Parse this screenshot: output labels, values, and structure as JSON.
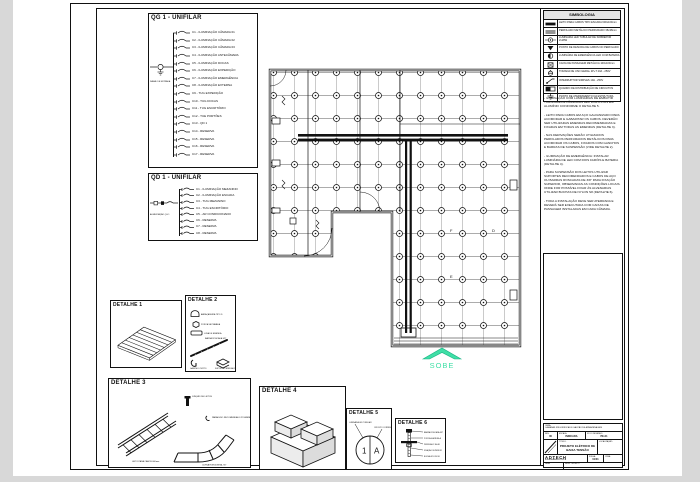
{
  "colors": {
    "background": "#d8d8d8",
    "paper": "#ffffff",
    "ink": "#111111",
    "accent_teal": "#3fdfa6",
    "accent_teal_dark": "#17b183"
  },
  "qg_panel": {
    "title": "QG 1 - UNIFILAR",
    "feeder_label": "RAMAL DE ENTRADA",
    "circuits": [
      "C1 - ILUMINAÇÃO CÂMARA 01",
      "C2 - ILUMINAÇÃO CÂMARA 02",
      "C3 - ILUMINAÇÃO CÂMARA 03",
      "C4 - ILUMINAÇÃO ANTECÂMARA",
      "C5 - ILUMINAÇÃO DOCAS",
      "C6 - ILUMINAÇÃO EXPEDIÇÃO",
      "C7 - ILUMINAÇÃO EMERGÊNCIA",
      "C8 - ILUMINAÇÃO EXTERNA",
      "C9 - TUG EXPEDIÇÃO",
      "C10 - TUG DOCAS",
      "C11 - TUG ESCRITÓRIO",
      "C12 - TUE PORTÕES",
      "C13 - QD 1",
      "C14 - RESERVA",
      "C15 - RESERVA",
      "C16 - RESERVA",
      "C17 - RESERVA"
    ]
  },
  "qd_panel": {
    "title": "QD 1 - UNIFILAR",
    "feeder_label": "ALIMENTAÇÃO QG 1",
    "circuits": [
      "C1 - ILUMINAÇÃO MEZANINO",
      "C2 - ILUMINAÇÃO ESCADA",
      "C3 - TUG MEZANINO",
      "C4 - TUG ESCRITÓRIO",
      "C5 - AR CONDICIONADO",
      "C6 - RESERVA",
      "C7 - RESERVA",
      "C8 - RESERVA"
    ]
  },
  "legend": {
    "title": "SIMBOLOGIA",
    "rows": [
      {
        "icon": "cable-tray-line-icon",
        "label": "LEITO PARA CABOS TIPO ESCADA 600x100mm"
      },
      {
        "icon": "perfilado-line-icon",
        "label": "PERFILADO METÁLICO PERFURADO 38x38mm"
      },
      {
        "icon": "luminaire-icon",
        "label": "LUMINÁRIA LED TUBULAR DE SOBREPOR 2x18W"
      },
      {
        "icon": "drop-point-icon",
        "label": "PONTO DE DESCIDA DE CABOS NO PERFILADO"
      },
      {
        "icon": "emergency-luminaire-icon",
        "label": "LUMINÁRIA DE EMERGÊNCIA LED COM BATERIA"
      },
      {
        "icon": "junction-box-icon",
        "label": "CAIXA DE PASSAGEM METÁLICA 100x100mm"
      },
      {
        "icon": "outlet-icon",
        "label": "TOMADA DE USO GERAL 2P+T 20A - 250V"
      },
      {
        "icon": "switch-icon",
        "label": "INTERRUPTOR SIMPLES 10A - 250V"
      },
      {
        "icon": "panel-icon",
        "label": "QUADRO DE DISTRIBUIÇÃO DE CIRCUITOS"
      },
      {
        "icon": "ground-icon",
        "label": "PONTO DE ATERRAMENTO DA ESTRUTURA"
      }
    ]
  },
  "notes": {
    "paragraphs": [
      "- ILUMINAÇÃO COM LUMINÁRIAS DE EMBUTIR TUBULARES E LÂMPADAS LED DISPOSTAS EM ALUMÍNIO CONFORME O DETALHE 5.",
      "- LEITO PARA CABOS EM AÇO GALVANIZADO PARA ACOMODAR E GABARITAR OS CABOS. DEVERÃO SER UTILIZADAS EMENDAS RECOMENDADAS E FIXADAS EM TODAS AS EMENDAS (DETALHE 3).",
      "- NAS DERIVAÇÕES SERÃO UTILIZADOS PERFILADOS PERFURADOS METÁLICOS PARA ACOMODAR OS CABOS, FIXADOS COM GANCHOS E BARRAS DE SUSPENSÃO (VIDE DETALHE 2).",
      "- ILUMINAÇÃO DE EMERGÊNCIA: INSTALAR LUMINÁRIA DE LED COM DOIS FARÓIS E BATERIA (DETALHE 4).",
      "- PARA SUSPENSÃO DOS LEITOS UTILIZAR SUPORTES RECOMENDADOS E CABOS DE AÇO OU BARRAS ROSCADAS DE 3/8\" PARA FIXAÇÃO SUPERIOR, OBSERVADAS AS CONDIÇÕES LOCAIS. ONDE FOR POSSÍVEL FIXAR ÀS ALVENARIAS UTILIZAR BUCHAS DE NYLON S8 (DETALHE 6).",
      "- TODA A INSTALAÇÃO DEVE SER ATERRADA E DEVERÁ SER EXECUTADA COM CAIXAS DE PASSAGEM INSTALADAS EM CADA CÂMARA."
    ]
  },
  "plan": {
    "stair_label": "SOBE",
    "room_tags": [
      "F",
      "D",
      "E"
    ]
  },
  "details": {
    "d1": {
      "title": "DETALHE 1"
    },
    "d2": {
      "title": "DETALHE 2",
      "labels": [
        "ABRAÇADEIRA TIPO D",
        "PORCA SEXTAVADA",
        "LUVA DE EMENDA",
        "BARRA ROSCADA 3/8\"",
        "GANCHO CURTO",
        "SUPORTE PERFILADO"
      ]
    },
    "d3": {
      "title": "DETALHE 3",
      "labels": [
        "JUNÇÃO DE LEITOS",
        "PARAFUSO RECOMENDADO P/ EMENDA",
        "LEITO PARA CABOS 600mm",
        "CURVA HORIZONTAL 90°"
      ]
    },
    "d4": {
      "title": "DETALHE 4"
    },
    "d5": {
      "title": "DETALHE 5",
      "left_mark": "1",
      "right_mark": "A",
      "labels": [
        "LUMINÁRIA LED TUBULAR",
        "CIRCUITO CORRESPONDENTE"
      ]
    },
    "d6": {
      "title": "DETALHE 6",
      "labels": [
        "BARRA ROSCADA 3/8\"",
        "PORCA E ARRUELA",
        "PERFILADO 38x38",
        "FIXAÇÃO SUPERIOR",
        "BUCHA NYLON S8"
      ]
    }
  },
  "titleblock": {
    "obra_label": "OBRA:",
    "obra": "CÂMARAS FRIGORÍFICAS E GALPÃO DE ARMAZENAGEM",
    "rev_label": "REV.",
    "rev": "00",
    "escala_label": "ESCALA",
    "escala": "INDICADA",
    "desenho_label": "Nº DO DESENHO",
    "desenho": "PE-01",
    "titulo_label": "TÍTULO:",
    "titulo": "PROJETO ELÉTRICO DE BAIXA TENSÃO",
    "local_label": "LOCALIZAÇÃO:",
    "logo": "ADTECH",
    "logo_sub": "ENGENHARIA ELÉTRICA",
    "folha_label": "FOLHA",
    "folha": "01/01",
    "data_label": "DATA",
    "resp_label": "RESP. TÉCNICO",
    "crea_label": "CREA"
  }
}
